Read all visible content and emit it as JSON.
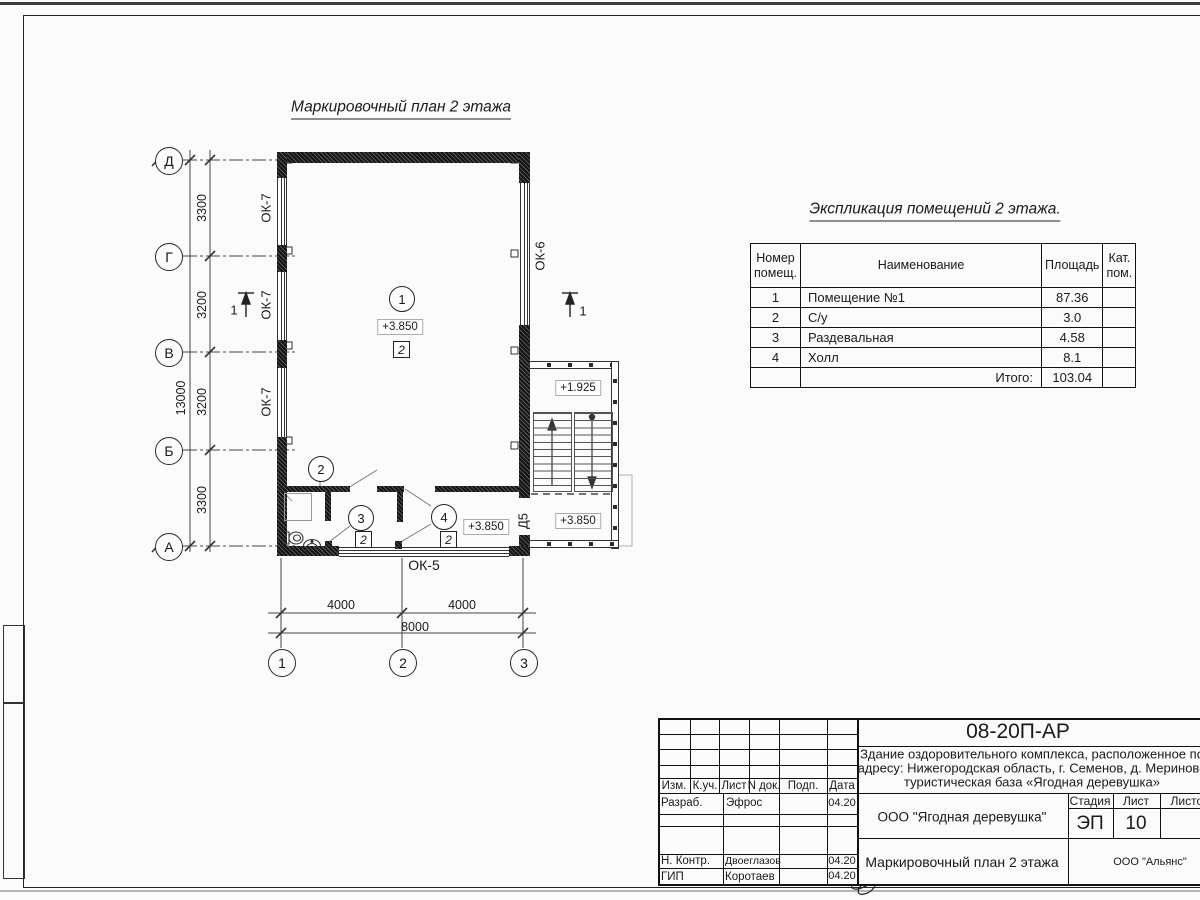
{
  "plan": {
    "title": "Маркировочный план 2 этажа",
    "axes_left": [
      "Д",
      "Г",
      "В",
      "Б",
      "А"
    ],
    "axes_bottom": [
      "1",
      "2",
      "3"
    ],
    "dims_left": [
      "3300",
      "3200",
      "3200",
      "3300"
    ],
    "dim_left_total": "13000",
    "dims_bottom": [
      "4000",
      "4000"
    ],
    "dim_bottom_total": "8000",
    "labels": {
      "ok7": "ОК-7",
      "ok6": "ОК-6",
      "ok5": "ОК-5",
      "d5": "Д5",
      "section": "1"
    },
    "marker": "2",
    "rooms": {
      "r1": "1",
      "r2": "2",
      "r3": "3",
      "r4": "4"
    },
    "elevations": {
      "main": "+3.850",
      "room4": "+3.850",
      "stair_lower": "+3.850",
      "stair_upper": "+1.925"
    }
  },
  "explication": {
    "title": "Экспликация помещений 2 этажа.",
    "headers": {
      "num": "Номер помещ.",
      "name": "Наименование",
      "area": "Площадь",
      "cat": "Кат. пом."
    },
    "rows": [
      {
        "num": "1",
        "name": "Помещение №1",
        "area": "87.36",
        "cat": ""
      },
      {
        "num": "2",
        "name": "С/у",
        "area": "3.0",
        "cat": ""
      },
      {
        "num": "3",
        "name": "Раздевальная",
        "area": "4.58",
        "cat": ""
      },
      {
        "num": "4",
        "name": "Холл",
        "area": "8.1",
        "cat": ""
      }
    ],
    "total_label": "Итого:",
    "total_value": "103.04"
  },
  "title_block": {
    "doc_number": "08-20П-АР",
    "project_line1": "Здание оздоровительного комплекса, расположенное по",
    "project_line2": "адресу: Нижегородская область, г. Семенов, д. Мериново",
    "project_line3": "туристическая база «Ягодная деревушка»",
    "cols": {
      "izm": "Изм.",
      "kuch": "К.уч.",
      "list": "Лист",
      "ndok": "N док.",
      "podp": "Подп.",
      "data": "Дата"
    },
    "row_razrab": {
      "role": "Разраб.",
      "name": "Эфрос",
      "date": "04.20"
    },
    "row_nkontr": {
      "role": "Н. Контр.",
      "name": "Двоеглазов",
      "date": "04.20"
    },
    "row_gip": {
      "role": "ГИП",
      "name": "Коротаев",
      "date": "04.20"
    },
    "company": "ООО \"Ягодная деревушка\"",
    "stage_label": "Стадия",
    "sheet_label": "Лист",
    "sheets_label": "Листов",
    "stage_value": "ЭП",
    "sheet_value": "10",
    "drawing_name": "Маркировочный план 2 этажа",
    "org_name": "ООО \"Альянс\""
  }
}
